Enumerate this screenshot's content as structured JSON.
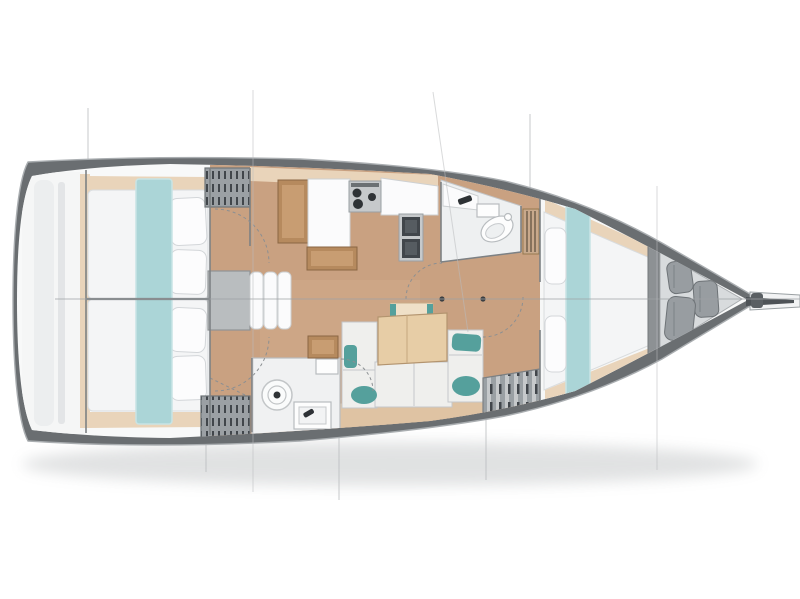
{
  "plan": {
    "kind": "sailboat-interior-floor-plan",
    "orientation": "bow-right",
    "visible_text": ""
  },
  "palette": {
    "hull": "#6a6e71",
    "outline": "#aaaeb1",
    "deck": "#f8f9f9",
    "floor": "#c9a181",
    "shelf": "#e9d4ba",
    "woodDark": "#b68a5e",
    "woodFrame": "#8a6644",
    "woodIn": "#c89d72",
    "table": "#e7cda6",
    "bench": "#efe0c8",
    "teal": "#abd5d7",
    "tealDark": "#55a09c",
    "mattress": "#f4f5f6",
    "cushion": "#efefed",
    "white": "#fbfbfc",
    "lockerGray": "#9ba0a4",
    "slatDark": "#41464b",
    "wall": "#7d8184",
    "line": "#b9bcbe",
    "metal": "#8d9194",
    "dark": "#2f3336",
    "headFloor": "#eef0f1",
    "anchorFloor": "#d8dbdd",
    "cyl": "#989da1"
  },
  "areas": [
    {
      "id": "transom-garage",
      "label": "Transom stowage"
    },
    {
      "id": "aft-cabin-port",
      "label": "Aft cabin (port) double berth"
    },
    {
      "id": "aft-cabin-starboard",
      "label": "Aft cabin (starboard) double berth"
    },
    {
      "id": "wardrobe-lockers",
      "label": "Hatched wardrobe lockers"
    },
    {
      "id": "companionway-steps",
      "label": "Companionway steps"
    },
    {
      "id": "galley",
      "label": "Galley"
    },
    {
      "id": "stove",
      "label": "Three-burner stove"
    },
    {
      "id": "galley-sink",
      "label": "Double galley sink"
    },
    {
      "id": "forward-head",
      "label": "Forward head (bathroom)"
    },
    {
      "id": "toilet",
      "label": "Toilet"
    },
    {
      "id": "saloon",
      "label": "Saloon"
    },
    {
      "id": "dining-table",
      "label": "Saloon dining table"
    },
    {
      "id": "settee",
      "label": "U-shaped settee with teal pillows"
    },
    {
      "id": "aft-head",
      "label": "Aft head with shower"
    },
    {
      "id": "tech-locker",
      "label": "Louvered locker"
    },
    {
      "id": "forward-cabin",
      "label": "Forward cabin"
    },
    {
      "id": "v-berth",
      "label": "V-berth"
    },
    {
      "id": "anchor-locker",
      "label": "Anchor locker with fenders"
    },
    {
      "id": "bowsprit",
      "label": "Bowsprit"
    },
    {
      "id": "hull",
      "label": "Hull outline"
    },
    {
      "id": "centerline",
      "label": "Centerline"
    }
  ]
}
